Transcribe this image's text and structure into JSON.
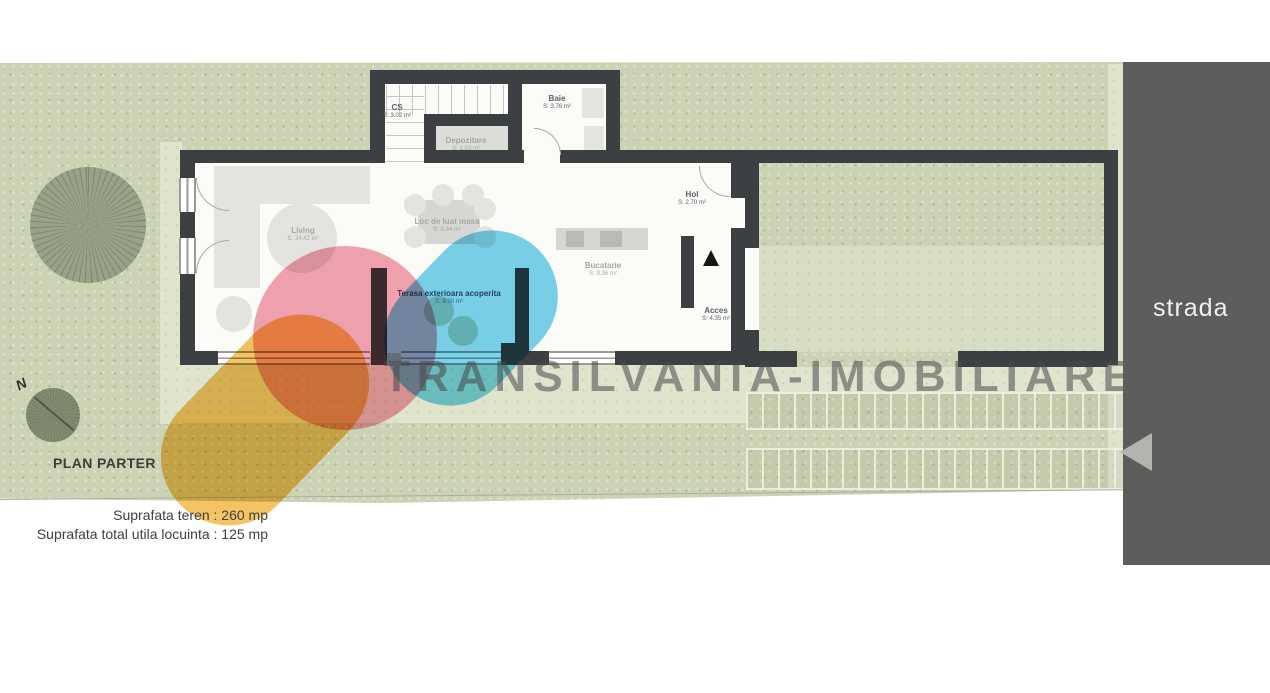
{
  "plan": {
    "title": "PLAN PARTER",
    "surface_land": "Suprafata teren : 260 mp",
    "surface_house": "Suprafata total utila locuinta : 125 mp",
    "street_label": "strada",
    "compass_label": "N"
  },
  "watermark": {
    "text": "TRANSILVANIA-IMOBILIARE",
    "colors": {
      "pink": "#ef8fa0",
      "cyan": "#5cc8e7",
      "yellow": "#f2b640",
      "text_gray": "#4a4a4a"
    }
  },
  "palette": {
    "wall": "#3d4043",
    "lawn": "#ccd3b4",
    "street_strip": "#5d5d5b"
  },
  "rooms": {
    "cs": {
      "name": "CS",
      "area": "S: 3.02 m²"
    },
    "depozitare": {
      "name": "Depozitare",
      "area": "S: 2.53 m²"
    },
    "baie": {
      "name": "Baie",
      "area": "S: 3.76 m²"
    },
    "living": {
      "name": "Living",
      "area": "S: 34.42 m²"
    },
    "dining": {
      "name": "Loc de luat masa",
      "area": "S: 8.34 m²"
    },
    "bucatarie": {
      "name": "Bucatarie",
      "area": "S: 9.36 m²"
    },
    "hol": {
      "name": "Hol",
      "area": "S: 2.70 m²"
    },
    "acces": {
      "name": "Acces",
      "area": "S: 4.35 m²"
    },
    "terasa": {
      "name": "Terasa exterioara acoperita",
      "area": "S: 8.00 m²"
    }
  }
}
